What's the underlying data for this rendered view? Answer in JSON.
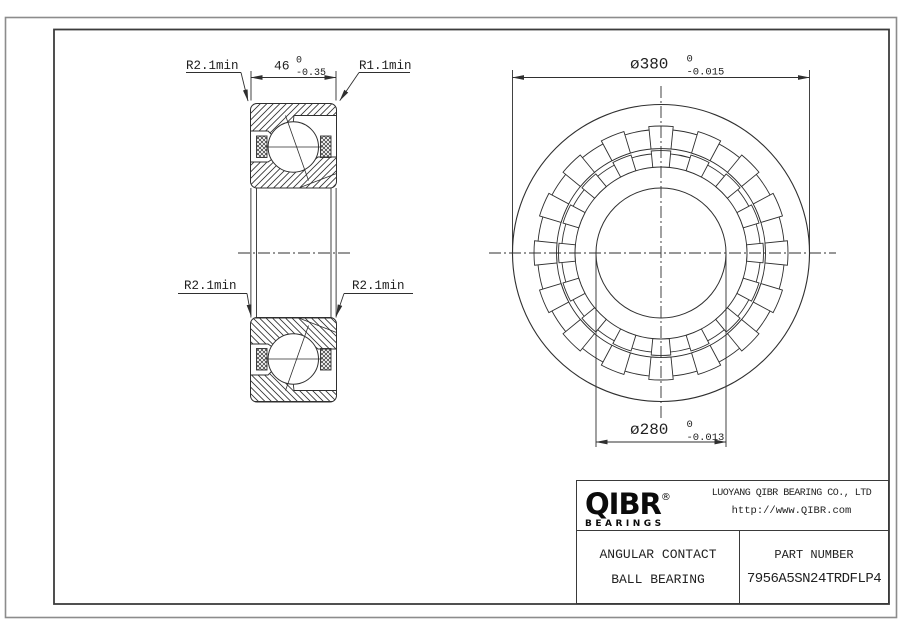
{
  "page": {
    "background": "#ffffff",
    "line_color": "#2f2f2f",
    "frame_outer_color": "#8c8c8c",
    "frame_inner_color": "#3c3c3c"
  },
  "views": {
    "section": {
      "dim_width": {
        "value": "46",
        "tol_upper": "0",
        "tol_lower": "-0.35"
      },
      "label_r_outer_left": "R2.1min",
      "label_r_outer_right": "R1.1min",
      "label_r_mid_left": "R2.1min",
      "label_r_mid_right": "R2.1min"
    },
    "front": {
      "dim_od": {
        "value": "ø380",
        "tol_upper": "0",
        "tol_lower": "-0.015"
      },
      "dim_bore": {
        "value": "ø280",
        "tol_upper": "0",
        "tol_lower": "-0.013"
      }
    }
  },
  "title_block": {
    "logo": {
      "brand": "QIBR",
      "registered": "®",
      "tagline": "BEARINGS"
    },
    "company": "LUOYANG QIBR BEARING CO., LTD",
    "website": "http://www.QIBR.com",
    "product": {
      "line1": "ANGULAR CONTACT",
      "line2": "BALL BEARING"
    },
    "part": {
      "label": "PART NUMBER",
      "number": "7956A5SN24TRDFLP4"
    }
  }
}
